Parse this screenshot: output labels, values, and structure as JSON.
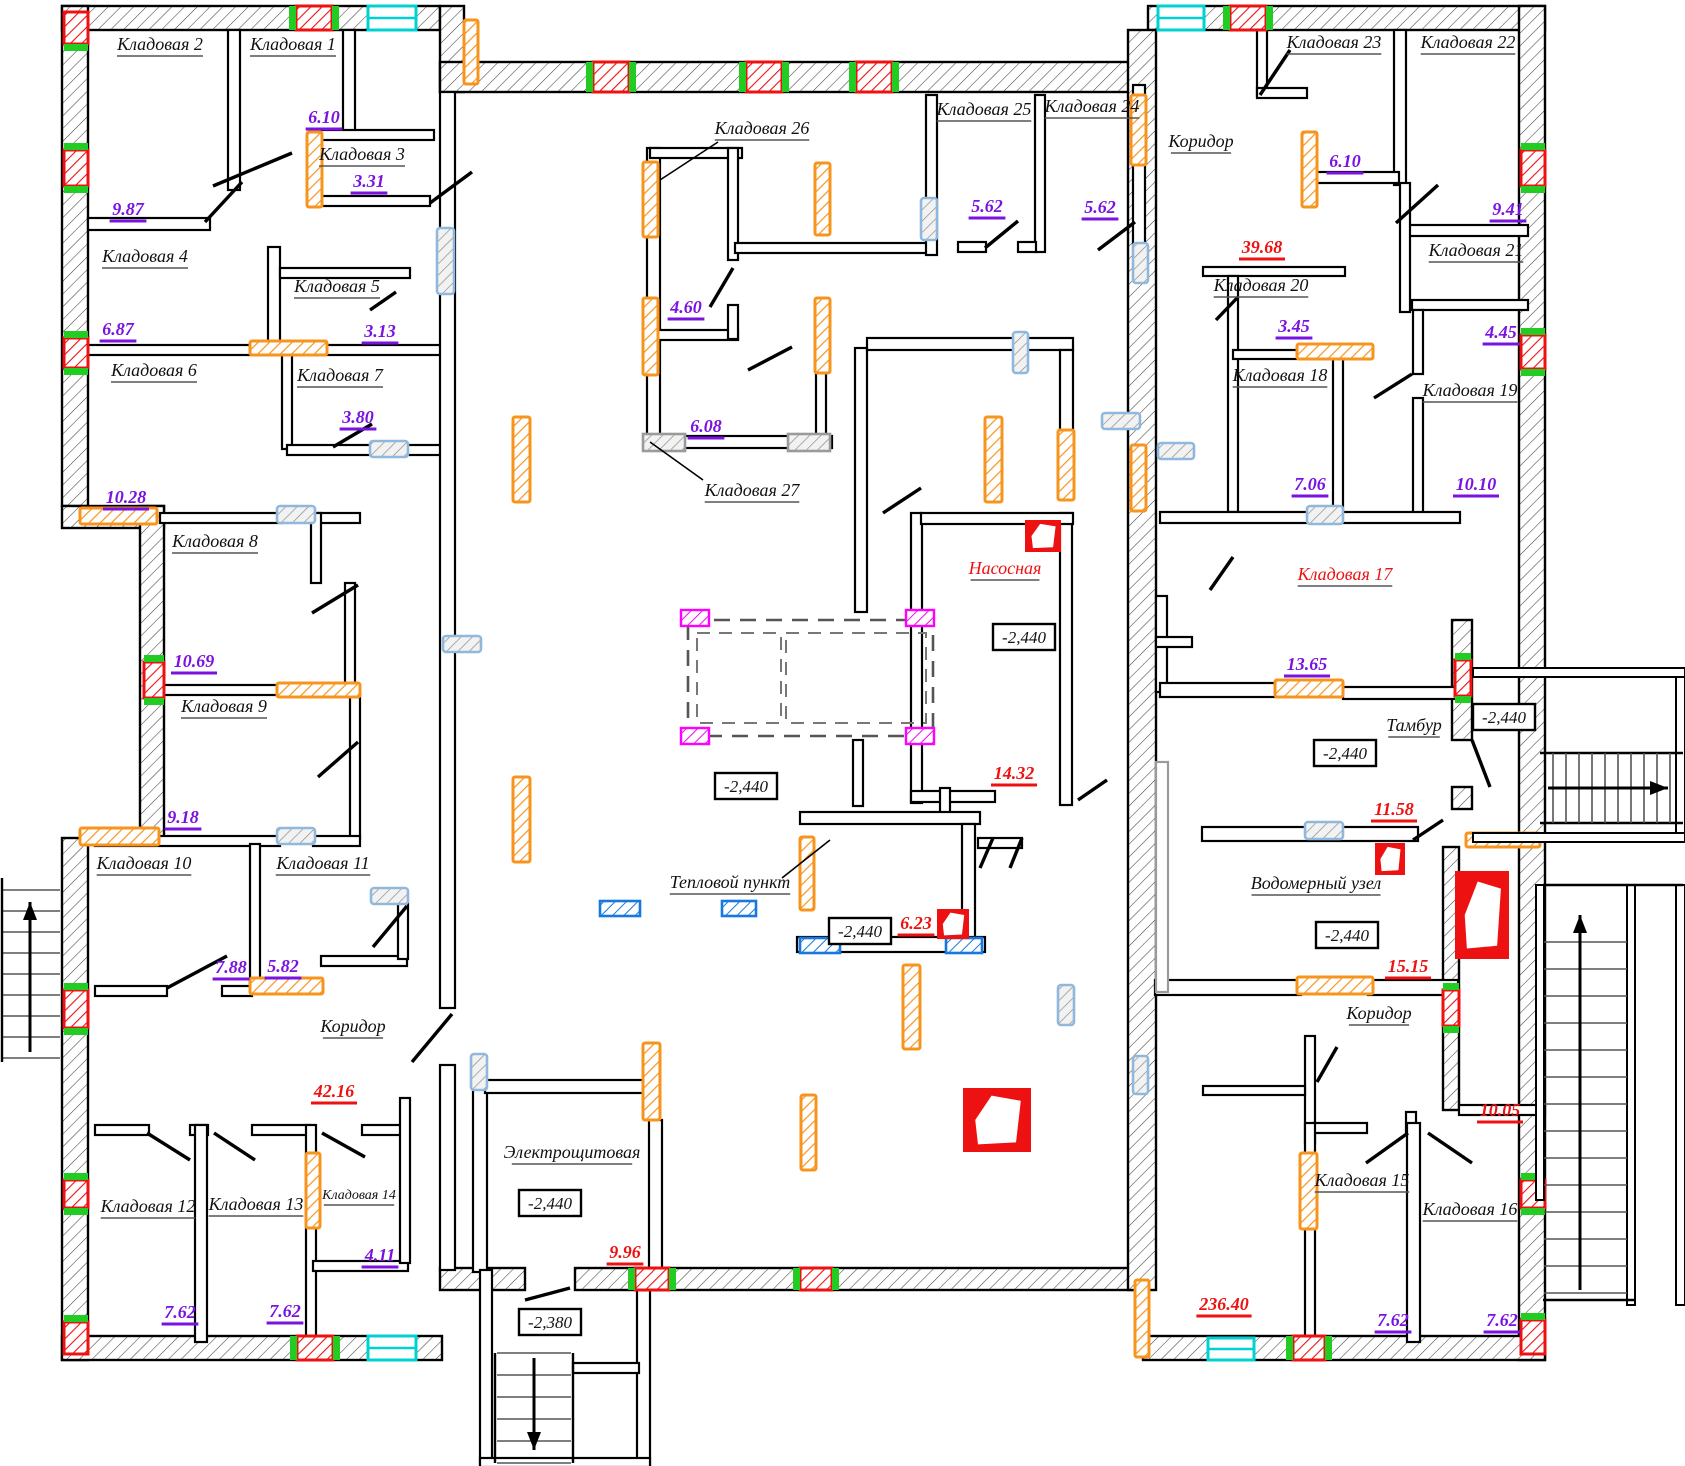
{
  "plan": {
    "storage_rooms": {
      "k1": {
        "label": "Кладовая 1",
        "area": "6.10"
      },
      "k2": {
        "label": "Кладовая 2",
        "area": "9.87"
      },
      "k3": {
        "label": "Кладовая 3",
        "area": "3.31"
      },
      "k4": {
        "label": "Кладовая 4",
        "area": "6.87"
      },
      "k5": {
        "label": "Кладовая 5",
        "area": "3.13"
      },
      "k6": {
        "label": "Кладовая 6",
        "area": "10.28"
      },
      "k7": {
        "label": "Кладовая 7",
        "area": "3.80"
      },
      "k8": {
        "label": "Кладовая 8",
        "area": "10.69"
      },
      "k9": {
        "label": "Кладовая 9",
        "area": "9.18"
      },
      "k10": {
        "label": "Кладовая 10",
        "area": "7.88"
      },
      "k11": {
        "label": "Кладовая 11",
        "area": "5.82"
      },
      "k12": {
        "label": "Кладовая 12",
        "area": "7.62"
      },
      "k13": {
        "label": "Кладовая 13",
        "area": "7.62"
      },
      "k14": {
        "label": "Кладовая 14",
        "area": "4.11"
      },
      "k15": {
        "label": "Кладовая 15",
        "area": "7.62"
      },
      "k16": {
        "label": "Кладовая 16",
        "area": "7.62"
      },
      "k17": {
        "label": "Кладовая 17",
        "area": "13.65"
      },
      "k18": {
        "label": "Кладовая 18",
        "area": "7.06"
      },
      "k19": {
        "label": "Кладовая 19",
        "area": "10.10"
      },
      "k20": {
        "label": "Кладовая 20",
        "area": "3.45"
      },
      "k21": {
        "label": "Кладовая 21",
        "area": "4.45"
      },
      "k22": {
        "label": "Кладовая 22",
        "area": "9.41"
      },
      "k23": {
        "label": "Кладовая 23",
        "area": "6.10"
      },
      "k24": {
        "label": "Кладовая 24",
        "area": "5.62"
      },
      "k25": {
        "label": "Кладовая 25",
        "area": "5.62"
      },
      "k26": {
        "label": "Кладовая 26",
        "area": "4.60"
      },
      "k27": {
        "label": "Кладовая 27",
        "area": "6.08"
      }
    },
    "technical_rooms": {
      "pump_room": {
        "label": "Насосная",
        "area": "14.32"
      },
      "heat_point": {
        "label": "Тепловой пункт",
        "area": "6.23"
      },
      "water_meter_unit": {
        "label": "Водомерный узел",
        "area": "15.15"
      },
      "electrical_room": {
        "label": "Электрощитовая",
        "area": "9.96"
      },
      "vestibule": {
        "label": "Тамбур"
      },
      "vent_shaft_area": {
        "area": "11.58"
      }
    },
    "corridors": {
      "left": {
        "label": "Коридор",
        "area": "42.16"
      },
      "top_right": {
        "label": "Коридор",
        "area": "39.68"
      },
      "bottom_right": {
        "label": "Коридор",
        "area": "10.05"
      }
    },
    "hall_area": "236.40",
    "elevations": {
      "basement": "-2,440",
      "stair_landing": "-2,380"
    },
    "colors": {
      "wall_line": "#000000",
      "area_purple": "#7a12e0",
      "technical_red": "#ee1111",
      "pilaster_orange": "#f7941e",
      "window_cyan": "#00d2d2",
      "lift_magenta": "#ff00ff",
      "plumbing_blue": "#1779e0",
      "joint_green": "#22cc22",
      "lintel_blue_gray": "#90b8dc",
      "lintel_gray": "#9a9a9a"
    }
  }
}
